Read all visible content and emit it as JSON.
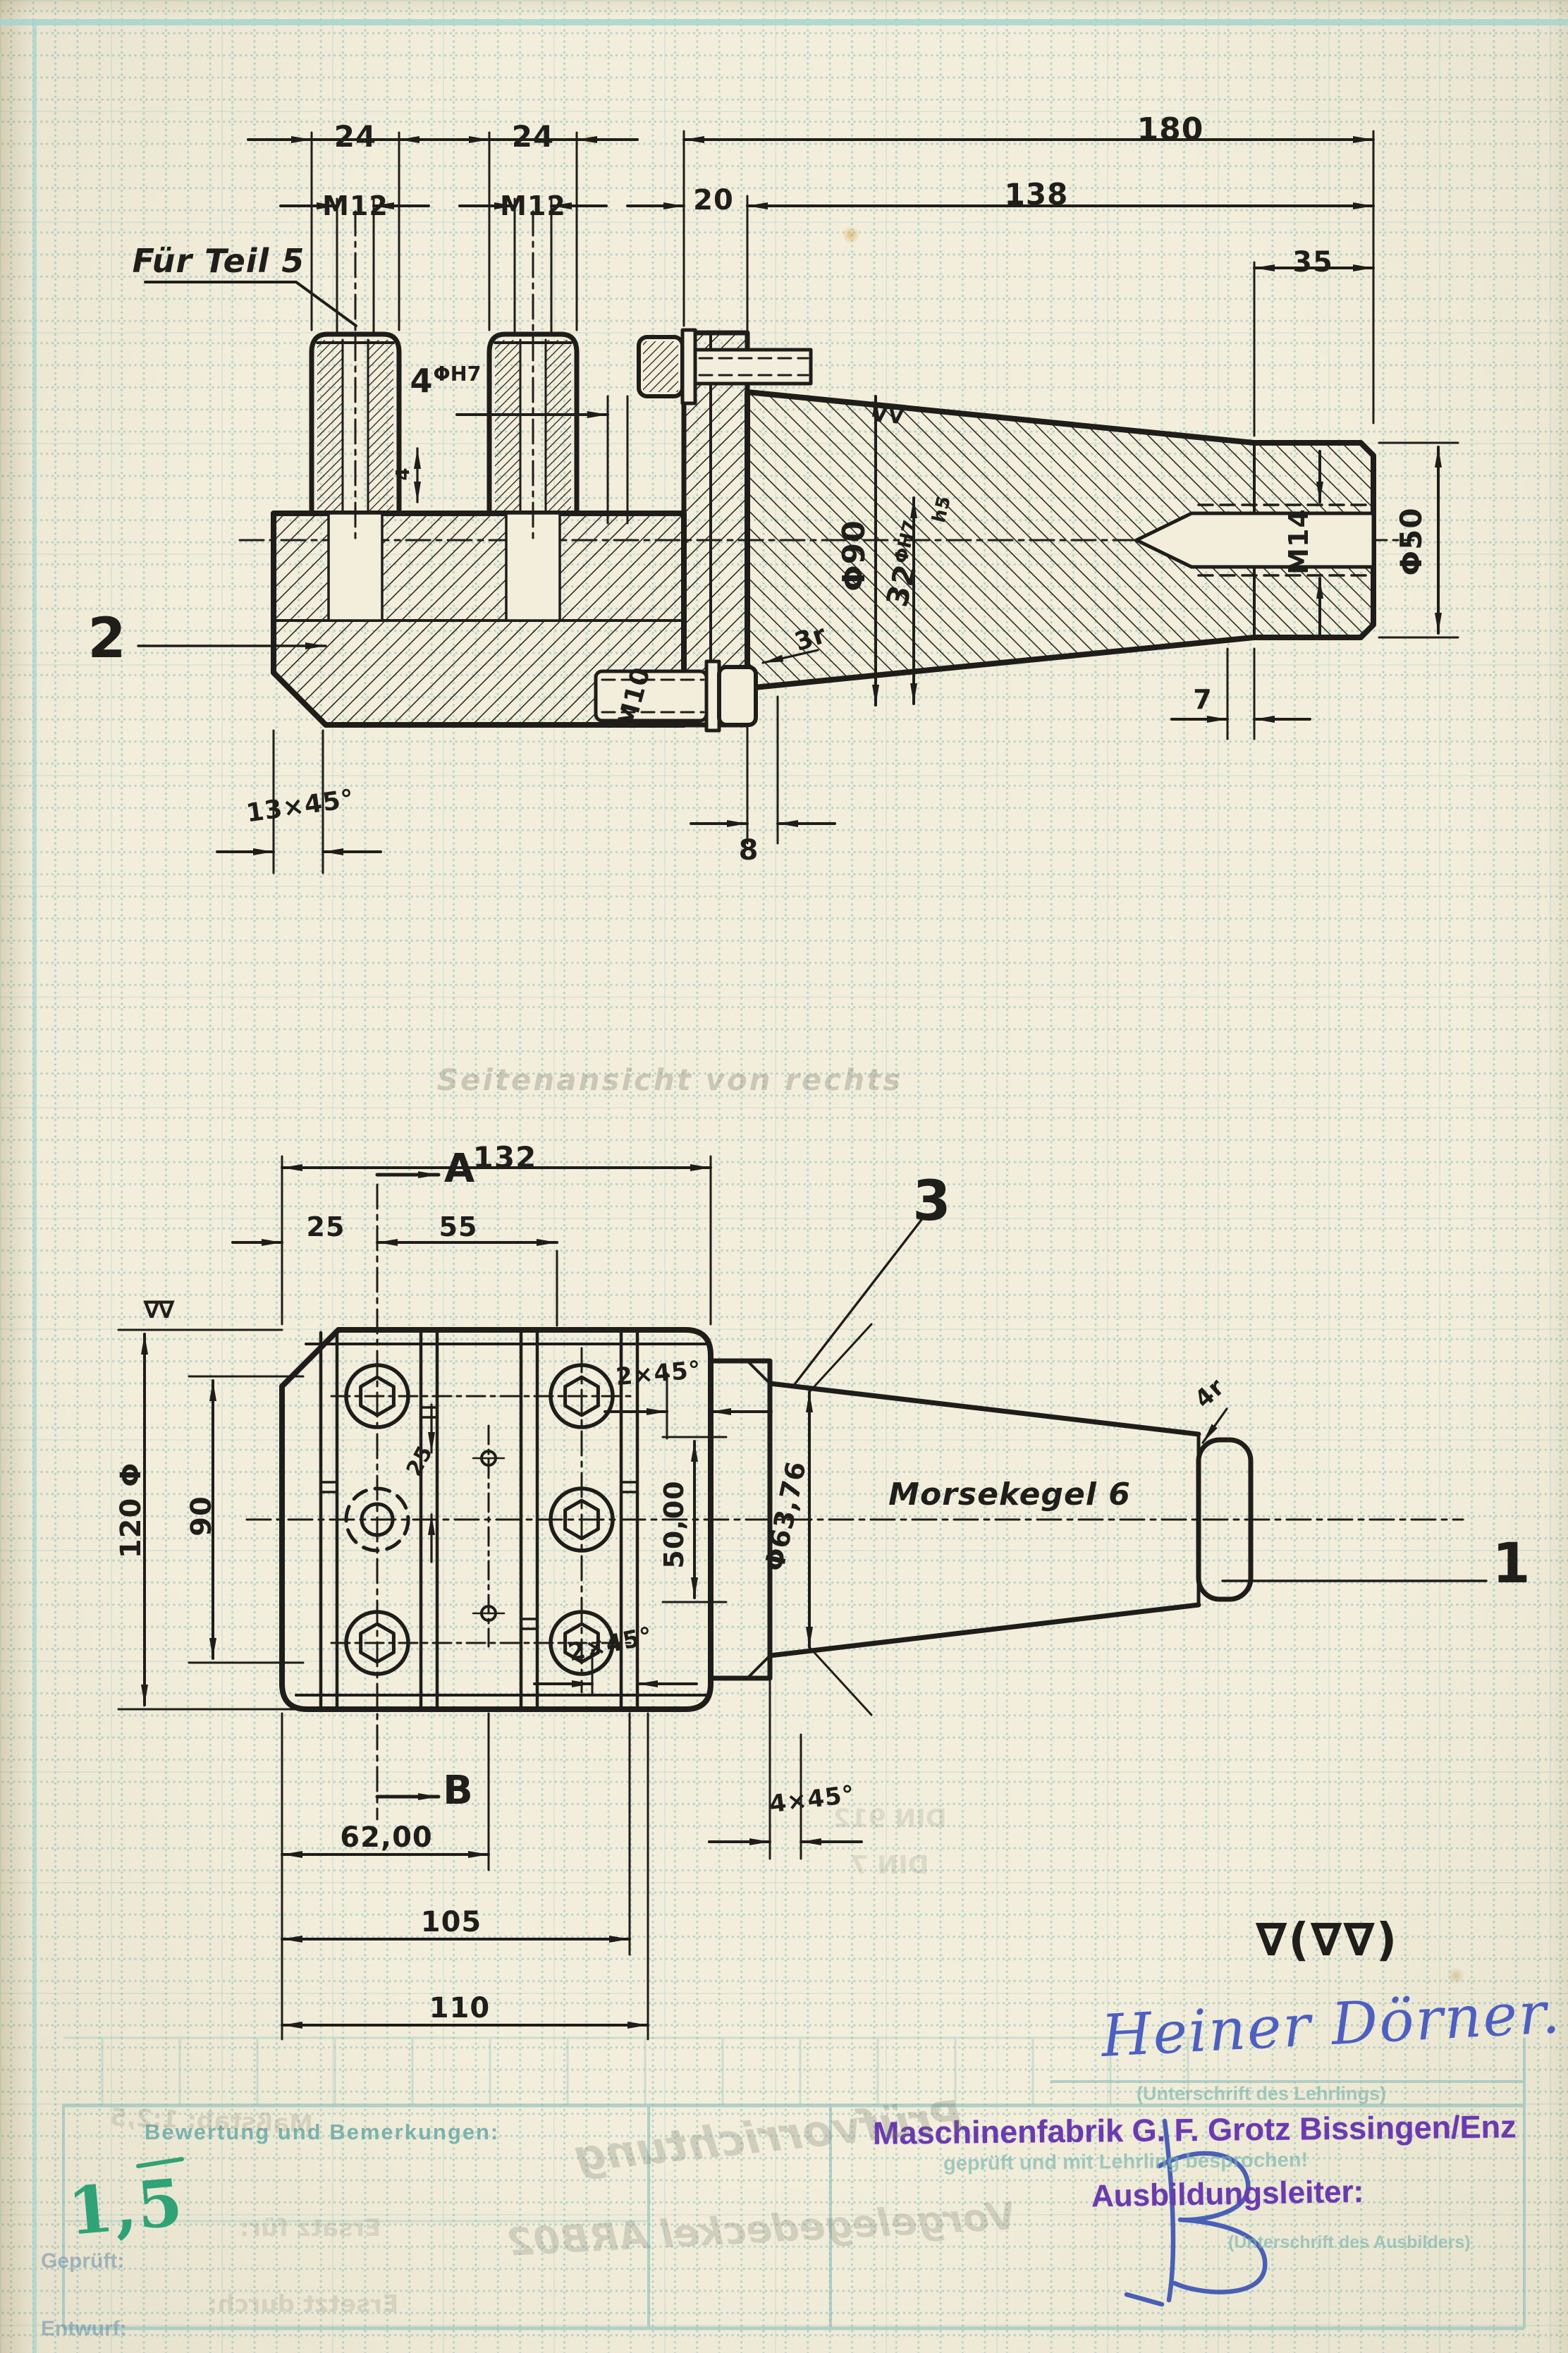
{
  "top_view": {
    "part_label": "2",
    "fuer_teil": "Für Teil 5",
    "d24_left": "24",
    "d24_right": "24",
    "m12_left": "M12",
    "m12_right": "M12",
    "d20": "20",
    "d138": "138",
    "d180": "180",
    "d35": "35",
    "hole_value": "4",
    "hole_tol": "ΦH7",
    "depth": "4",
    "bore_value": "32",
    "bore_tol": "ΦH7",
    "bore_fit": "h5",
    "m10": "M10",
    "phi90": "Φ90",
    "m14": "M14",
    "phi50": "Φ50",
    "r3": "3r",
    "d7": "7",
    "d8": "8",
    "chamfer13": "13×45°",
    "finish": "∇∇"
  },
  "front_view": {
    "part1_label": "1",
    "part3_label": "3",
    "d132": "132",
    "section_a": "A",
    "section_b": "B",
    "d25": "25",
    "d55": "55",
    "d120": "120 Φ",
    "d90": "90",
    "finish": "∇∇",
    "chamfer2_top": "2×45°",
    "chamfer2_bottom": "2×45°",
    "d50": "50,00",
    "d25_mid": "25",
    "phi636": "Φ63,76",
    "morse": "Morsekegel 6",
    "r4": "4r",
    "d62": "62,00",
    "d105": "105",
    "d110": "110",
    "chamfer4": "4×45°"
  },
  "notes": {
    "view_caption": "Seitenansicht von rechts"
  },
  "footer": {
    "finish_note": "∇(∇∇)",
    "bewertung": "Bewertung und Bemerkungen:",
    "grade": "1,5",
    "apprentice_signature": "Heiner Dörner.",
    "apprentice_caption": "(Unterschrift des Lehrlings)",
    "stamp_company": "Maschinenfabrik G. F. Grotz Bissingen/Enz",
    "stamp_checked": "geprüft und mit Lehrling besprochen!",
    "stamp_role": "Ausbildungsleiter:",
    "trainer_caption": "(Unterschrift des Ausbilders)",
    "field_geprueft": "Geprüft:",
    "field_entwurf": "Entwurf:"
  },
  "bleed": {
    "title1": "Prüfvorrichtung",
    "title2": "Vorgelegedeckel ARB02",
    "din1": "DIN 912",
    "din2": "DIN 7",
    "massstab": "Maßstab: 1:2,5",
    "ersatz": "Ersatz für:",
    "ersetzt": "Ersetzt durch:"
  }
}
